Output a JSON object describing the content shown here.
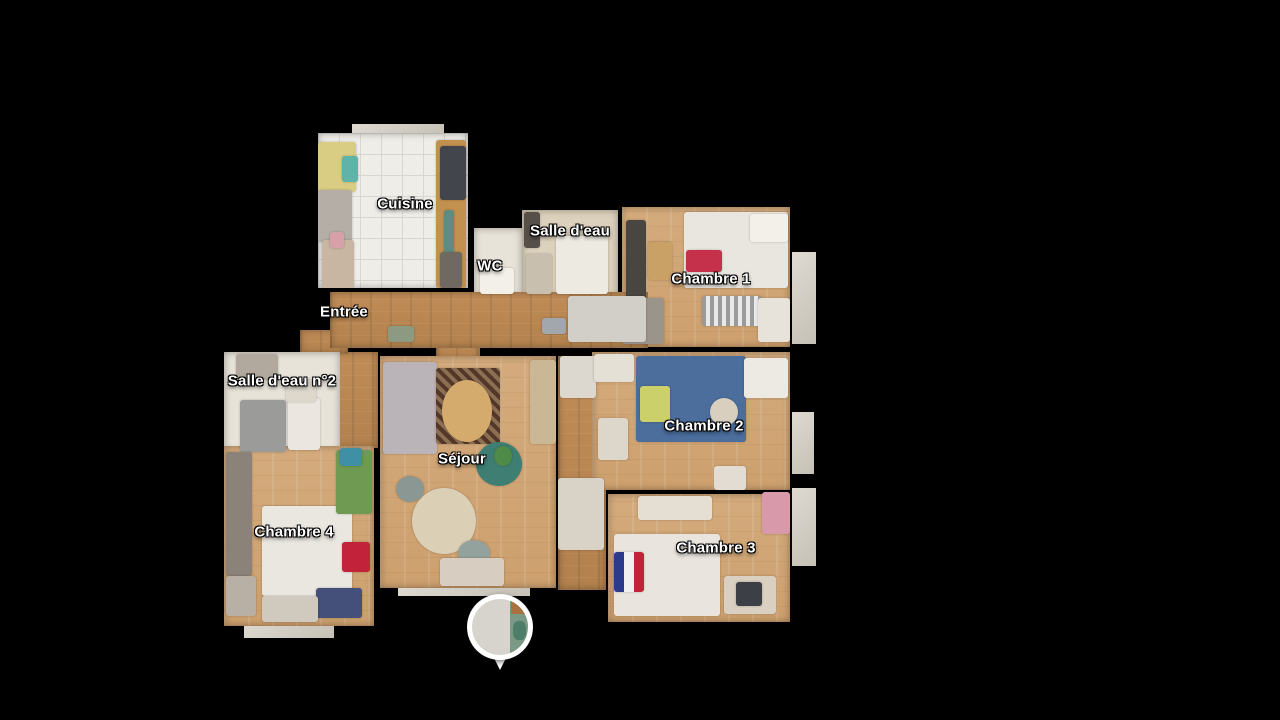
{
  "viewer": {
    "background": "#000000",
    "mode": "floorplan-view"
  },
  "floorplan": {
    "rooms": [
      {
        "id": "cuisine",
        "label": "Cuisine",
        "x": 318,
        "y": 133,
        "w": 150,
        "h": 155,
        "floor": "tile",
        "label_x": 405,
        "label_y": 204
      },
      {
        "id": "wc",
        "label": "WC",
        "x": 474,
        "y": 228,
        "w": 48,
        "h": 68,
        "floor": "plain-light",
        "label_x": 490,
        "label_y": 266
      },
      {
        "id": "salle-deau",
        "label": "Salle d'eau",
        "x": 522,
        "y": 210,
        "w": 96,
        "h": 86,
        "floor": "plain-beige",
        "label_x": 570,
        "label_y": 231
      },
      {
        "id": "chambre-1",
        "label": "Chambre 1",
        "x": 622,
        "y": 207,
        "w": 168,
        "h": 140,
        "floor": "wood-light",
        "label_x": 711,
        "label_y": 279
      },
      {
        "id": "entree",
        "label": "Entrée",
        "x": 330,
        "y": 292,
        "w": 318,
        "h": 56,
        "floor": "wood-dark",
        "label_x": 344,
        "label_y": 312
      },
      {
        "id": "salle-deau-2",
        "label": "Salle d'eau n°2",
        "x": 224,
        "y": 352,
        "w": 116,
        "h": 100,
        "floor": "plain-light",
        "label_x": 282,
        "label_y": 381
      },
      {
        "id": "sejour",
        "label": "Séjour",
        "x": 380,
        "y": 356,
        "w": 176,
        "h": 232,
        "floor": "wood-light",
        "label_x": 462,
        "label_y": 459
      },
      {
        "id": "chambre-2",
        "label": "Chambre 2",
        "x": 592,
        "y": 352,
        "w": 198,
        "h": 138,
        "floor": "wood-light",
        "label_x": 704,
        "label_y": 426
      },
      {
        "id": "chambre-4",
        "label": "Chambre 4",
        "x": 224,
        "y": 446,
        "w": 150,
        "h": 180,
        "floor": "wood-light",
        "label_x": 294,
        "label_y": 532
      },
      {
        "id": "chambre-3",
        "label": "Chambre 3",
        "x": 608,
        "y": 494,
        "w": 182,
        "h": 128,
        "floor": "wood-light",
        "label_x": 716,
        "label_y": 548
      }
    ],
    "patches": [
      {
        "id": "corridor-right",
        "x": 558,
        "y": 356,
        "w": 48,
        "h": 234,
        "floor": "wood-dark"
      },
      {
        "id": "chambre4-entry",
        "x": 332,
        "y": 352,
        "w": 46,
        "h": 96,
        "floor": "wood-dark"
      },
      {
        "id": "sejour-doorway",
        "x": 436,
        "y": 342,
        "w": 44,
        "h": 18,
        "floor": "wood-dark"
      },
      {
        "id": "entree-left-spur",
        "x": 300,
        "y": 330,
        "w": 48,
        "h": 24,
        "floor": "wood-dark"
      },
      {
        "id": "window-bay-1",
        "x": 792,
        "y": 252,
        "w": 24,
        "h": 92,
        "floor": "fragment"
      },
      {
        "id": "window-bay-2",
        "x": 792,
        "y": 412,
        "w": 22,
        "h": 62,
        "floor": "fragment"
      },
      {
        "id": "window-bay-3",
        "x": 792,
        "y": 488,
        "w": 24,
        "h": 78,
        "floor": "fragment"
      },
      {
        "id": "fragment-sejour-bottom",
        "x": 398,
        "y": 580,
        "w": 132,
        "h": 16,
        "floor": "fragment"
      },
      {
        "id": "fragment-chambre4-bottom",
        "x": 244,
        "y": 616,
        "w": 90,
        "h": 22,
        "floor": "fragment"
      },
      {
        "id": "fragment-cuisine-top",
        "x": 352,
        "y": 124,
        "w": 92,
        "h": 12,
        "floor": "fragment"
      }
    ],
    "furniture": [
      {
        "name": "kitchen-counter",
        "x": 436,
        "y": 140,
        "w": 30,
        "h": 148,
        "color": "#c2914f"
      },
      {
        "name": "kitchen-appliance",
        "x": 440,
        "y": 146,
        "w": 26,
        "h": 54,
        "color": "#42464c"
      },
      {
        "name": "kitchen-teal-strip",
        "x": 444,
        "y": 210,
        "w": 10,
        "h": 70,
        "color": "#5e8d80"
      },
      {
        "name": "kitchen-dark-low",
        "x": 440,
        "y": 252,
        "w": 22,
        "h": 36,
        "color": "#6f6961"
      },
      {
        "name": "kitchen-clutter-yellow",
        "x": 318,
        "y": 142,
        "w": 38,
        "h": 50,
        "color": "#d9cd84"
      },
      {
        "name": "kitchen-clutter-gray",
        "x": 318,
        "y": 190,
        "w": 34,
        "h": 52,
        "color": "#b5aea6"
      },
      {
        "name": "kitchen-clutter-tan",
        "x": 322,
        "y": 240,
        "w": 32,
        "h": 48,
        "color": "#c9b6a2"
      },
      {
        "name": "kitchen-clutter-teal",
        "x": 342,
        "y": 156,
        "w": 16,
        "h": 26,
        "color": "#5fb3a8"
      },
      {
        "name": "kitchen-clutter-pink",
        "x": 330,
        "y": 232,
        "w": 14,
        "h": 16,
        "color": "#d8a0a8"
      },
      {
        "name": "wc-fixture",
        "x": 480,
        "y": 268,
        "w": 34,
        "h": 26,
        "color": "#f3f0e9"
      },
      {
        "name": "bath1-shower",
        "x": 556,
        "y": 236,
        "w": 52,
        "h": 58,
        "color": "#edeae2"
      },
      {
        "name": "bath1-dark-unit",
        "x": 524,
        "y": 212,
        "w": 16,
        "h": 36,
        "color": "#565049"
      },
      {
        "name": "bath1-mat",
        "x": 526,
        "y": 254,
        "w": 26,
        "h": 40,
        "color": "#c9bfae"
      },
      {
        "name": "c1-bed",
        "x": 684,
        "y": 212,
        "w": 104,
        "h": 76,
        "color": "#e9e5df"
      },
      {
        "name": "c1-pillow",
        "x": 750,
        "y": 214,
        "w": 38,
        "h": 28,
        "color": "#f3f0e9"
      },
      {
        "name": "c1-red-blanket",
        "x": 686,
        "y": 250,
        "w": 36,
        "h": 22,
        "color": "#c5304a"
      },
      {
        "name": "c1-radiator",
        "x": 702,
        "y": 296,
        "w": 60,
        "h": 30,
        "style": "striped"
      },
      {
        "name": "c1-wardrobe",
        "x": 626,
        "y": 220,
        "w": 20,
        "h": 80,
        "color": "#494540"
      },
      {
        "name": "c1-tan-box",
        "x": 648,
        "y": 242,
        "w": 24,
        "h": 38,
        "color": "#c9a166"
      },
      {
        "name": "c1-clutter",
        "x": 622,
        "y": 298,
        "w": 42,
        "h": 46,
        "color": "#9a948b"
      },
      {
        "name": "c1-white-corner",
        "x": 758,
        "y": 298,
        "w": 32,
        "h": 44,
        "color": "#e7e3db"
      },
      {
        "name": "hall-object-1",
        "x": 388,
        "y": 326,
        "w": 26,
        "h": 16,
        "color": "#8c9a82"
      },
      {
        "name": "hall-object-2",
        "x": 542,
        "y": 318,
        "w": 24,
        "h": 16,
        "color": "#a2a7ad"
      },
      {
        "name": "hall-fragment",
        "x": 568,
        "y": 296,
        "w": 78,
        "h": 46,
        "color": "#d2cfc8"
      },
      {
        "name": "bath2-shower",
        "x": 240,
        "y": 400,
        "w": 46,
        "h": 52,
        "color": "#9b9b99"
      },
      {
        "name": "bath2-tray",
        "x": 288,
        "y": 398,
        "w": 32,
        "h": 52,
        "color": "#ebe7e0"
      },
      {
        "name": "bath2-sink",
        "x": 286,
        "y": 380,
        "w": 30,
        "h": 22,
        "color": "#ddd7cc"
      },
      {
        "name": "bath2-shelf",
        "x": 236,
        "y": 354,
        "w": 42,
        "h": 26,
        "color": "#b1a99d"
      },
      {
        "name": "sofa",
        "x": 383,
        "y": 362,
        "w": 54,
        "h": 92,
        "color": "#bab3b7"
      },
      {
        "name": "rug",
        "x": 436,
        "y": 368,
        "w": 64,
        "h": 76,
        "style": "rug"
      },
      {
        "name": "coffee-table",
        "x": 442,
        "y": 380,
        "w": 50,
        "h": 62,
        "color": "#d4ab6d",
        "shape": "round"
      },
      {
        "name": "armchair-teal",
        "x": 476,
        "y": 442,
        "w": 46,
        "h": 44,
        "color": "#3f7e73",
        "shape": "round"
      },
      {
        "name": "dining-table",
        "x": 412,
        "y": 488,
        "w": 64,
        "h": 66,
        "color": "#dbcfb6",
        "shape": "round"
      },
      {
        "name": "dining-chair-1",
        "x": 396,
        "y": 476,
        "w": 28,
        "h": 26,
        "color": "#8a9792",
        "shape": "round"
      },
      {
        "name": "dining-chair-2",
        "x": 458,
        "y": 540,
        "w": 32,
        "h": 26,
        "color": "#93a29c",
        "shape": "round"
      },
      {
        "name": "sideboard",
        "x": 530,
        "y": 360,
        "w": 26,
        "h": 84,
        "color": "#c9b795"
      },
      {
        "name": "plant",
        "x": 494,
        "y": 446,
        "w": 18,
        "h": 20,
        "color": "#4f8a46",
        "shape": "round"
      },
      {
        "name": "sejour-clutter",
        "x": 440,
        "y": 558,
        "w": 64,
        "h": 28,
        "color": "#d7cec1"
      },
      {
        "name": "corridor-door",
        "x": 560,
        "y": 356,
        "w": 36,
        "h": 42,
        "color": "#ddd8cf"
      },
      {
        "name": "corridor-clutter",
        "x": 558,
        "y": 478,
        "w": 46,
        "h": 72,
        "color": "#d9d3c7"
      },
      {
        "name": "c2-bed",
        "x": 636,
        "y": 356,
        "w": 110,
        "h": 86,
        "color": "#4c6e9d"
      },
      {
        "name": "c2-pillow-yellow",
        "x": 640,
        "y": 386,
        "w": 30,
        "h": 36,
        "color": "#ccd06a"
      },
      {
        "name": "c2-pillow-white",
        "x": 744,
        "y": 358,
        "w": 44,
        "h": 40,
        "color": "#edeae3"
      },
      {
        "name": "c2-round-spot",
        "x": 710,
        "y": 398,
        "w": 28,
        "h": 28,
        "color": "#d9cfbe",
        "shape": "round"
      },
      {
        "name": "c2-dresser",
        "x": 594,
        "y": 354,
        "w": 40,
        "h": 28,
        "color": "#e5e0d6"
      },
      {
        "name": "c2-chair",
        "x": 598,
        "y": 418,
        "w": 30,
        "h": 42,
        "color": "#ddd6ca"
      },
      {
        "name": "c2-bag",
        "x": 714,
        "y": 466,
        "w": 32,
        "h": 24,
        "color": "#e2dcd2"
      },
      {
        "name": "c4-bed",
        "x": 262,
        "y": 506,
        "w": 90,
        "h": 90,
        "color": "#eae7e1"
      },
      {
        "name": "c4-red-blanket",
        "x": 342,
        "y": 542,
        "w": 28,
        "h": 30,
        "color": "#c3233a"
      },
      {
        "name": "c4-plant",
        "x": 336,
        "y": 450,
        "w": 36,
        "h": 64,
        "color": "#6f9a52"
      },
      {
        "name": "c4-teal-item",
        "x": 340,
        "y": 448,
        "w": 22,
        "h": 18,
        "color": "#3f8fa5"
      },
      {
        "name": "c4-clutter-left",
        "x": 226,
        "y": 452,
        "w": 26,
        "h": 124,
        "color": "#8b8279"
      },
      {
        "name": "c4-clutter-left2",
        "x": 226,
        "y": 576,
        "w": 30,
        "h": 40,
        "color": "#b8b0a4"
      },
      {
        "name": "c4-blue-item",
        "x": 316,
        "y": 588,
        "w": 46,
        "h": 30,
        "color": "#44507a"
      },
      {
        "name": "c4-clutter-bottom",
        "x": 262,
        "y": 596,
        "w": 56,
        "h": 26,
        "color": "#d0c9bd"
      },
      {
        "name": "c3-shelf",
        "x": 638,
        "y": 496,
        "w": 74,
        "h": 24,
        "color": "#e4ded3"
      },
      {
        "name": "c3-bed",
        "x": 614,
        "y": 534,
        "w": 106,
        "h": 82,
        "color": "#e9e5de"
      },
      {
        "name": "c3-flag-blanket",
        "x": 614,
        "y": 552,
        "w": 30,
        "h": 40,
        "style": "flag"
      },
      {
        "name": "c3-desk",
        "x": 724,
        "y": 576,
        "w": 52,
        "h": 38,
        "color": "#d9d0c1"
      },
      {
        "name": "c3-chair",
        "x": 736,
        "y": 582,
        "w": 26,
        "h": 24,
        "color": "#3c4046"
      },
      {
        "name": "c3-pink-items",
        "x": 762,
        "y": 492,
        "w": 28,
        "h": 42,
        "color": "#d89aab"
      }
    ],
    "pin": {
      "name": "panorama-pin",
      "cx": 500,
      "cy": 627,
      "ring_color": "#ffffff",
      "photo_left": "#d7d4ce",
      "photo_right": "#7a9a85",
      "photo_accent_top": "#a9713f",
      "photo_accent_dark": "#4e7d6a"
    }
  }
}
